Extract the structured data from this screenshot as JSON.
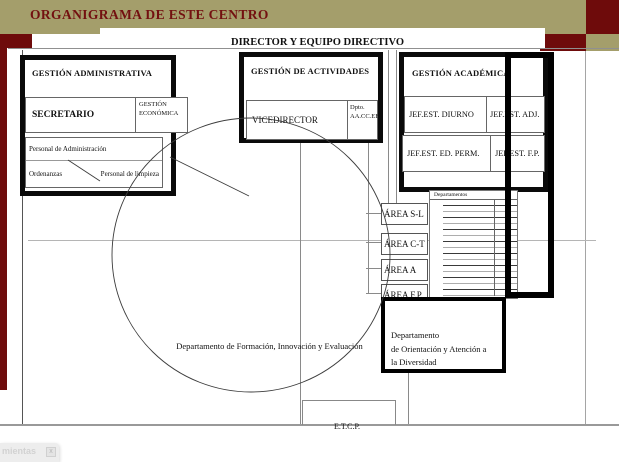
{
  "colors": {
    "olive": "#a49e6b",
    "darkred": "#6e0b0b",
    "titlered": "#731010",
    "linegray": "#8a8a8a"
  },
  "banner": {
    "title": "ORGANIGRAMA DE ESTE CENTRO"
  },
  "director_label": "DIRECTOR Y EQUIPO DIRECTIVO",
  "admin": {
    "title": "GESTIÓN ADMINISTRATIVA",
    "secretario": "SECRETARIO",
    "economica": "GESTIÓN ECONÓMICA",
    "personal_admin": "Personal de Administración",
    "ordenanzas": "Ordenanzas",
    "limpieza": "Personal de limpieza"
  },
  "actividades": {
    "title": "GESTIÓN DE ACTIVIDADES",
    "vicedirector": "VICEDIRECTOR",
    "dpto": "Dpto. AA.CC.EE."
  },
  "academica": {
    "title": "GESTIÓN ACADÉMICA",
    "jefaturas": [
      "JEF.EST. DIURNO",
      "JEF.EST. ADJ.",
      "JEF.EST. ED. PERM.",
      "JEF.EST. F.P."
    ]
  },
  "areas": [
    "ÁREA S-L",
    "ÁREA C-T",
    "ÁREA A",
    "ÁREA F.P."
  ],
  "departamentos": {
    "label": "Departamentos",
    "row_count": 16
  },
  "dep_formacion": "Departamento de Formación, Innovación y Evaluación",
  "dep_orientacion": {
    "lines": [
      "Departamento",
      "de Orientación y Atención a",
      "la Diversidad"
    ]
  },
  "etcp": "E.T.C.P.",
  "toolbar_fragment": {
    "title": "mientas",
    "close": "x"
  }
}
